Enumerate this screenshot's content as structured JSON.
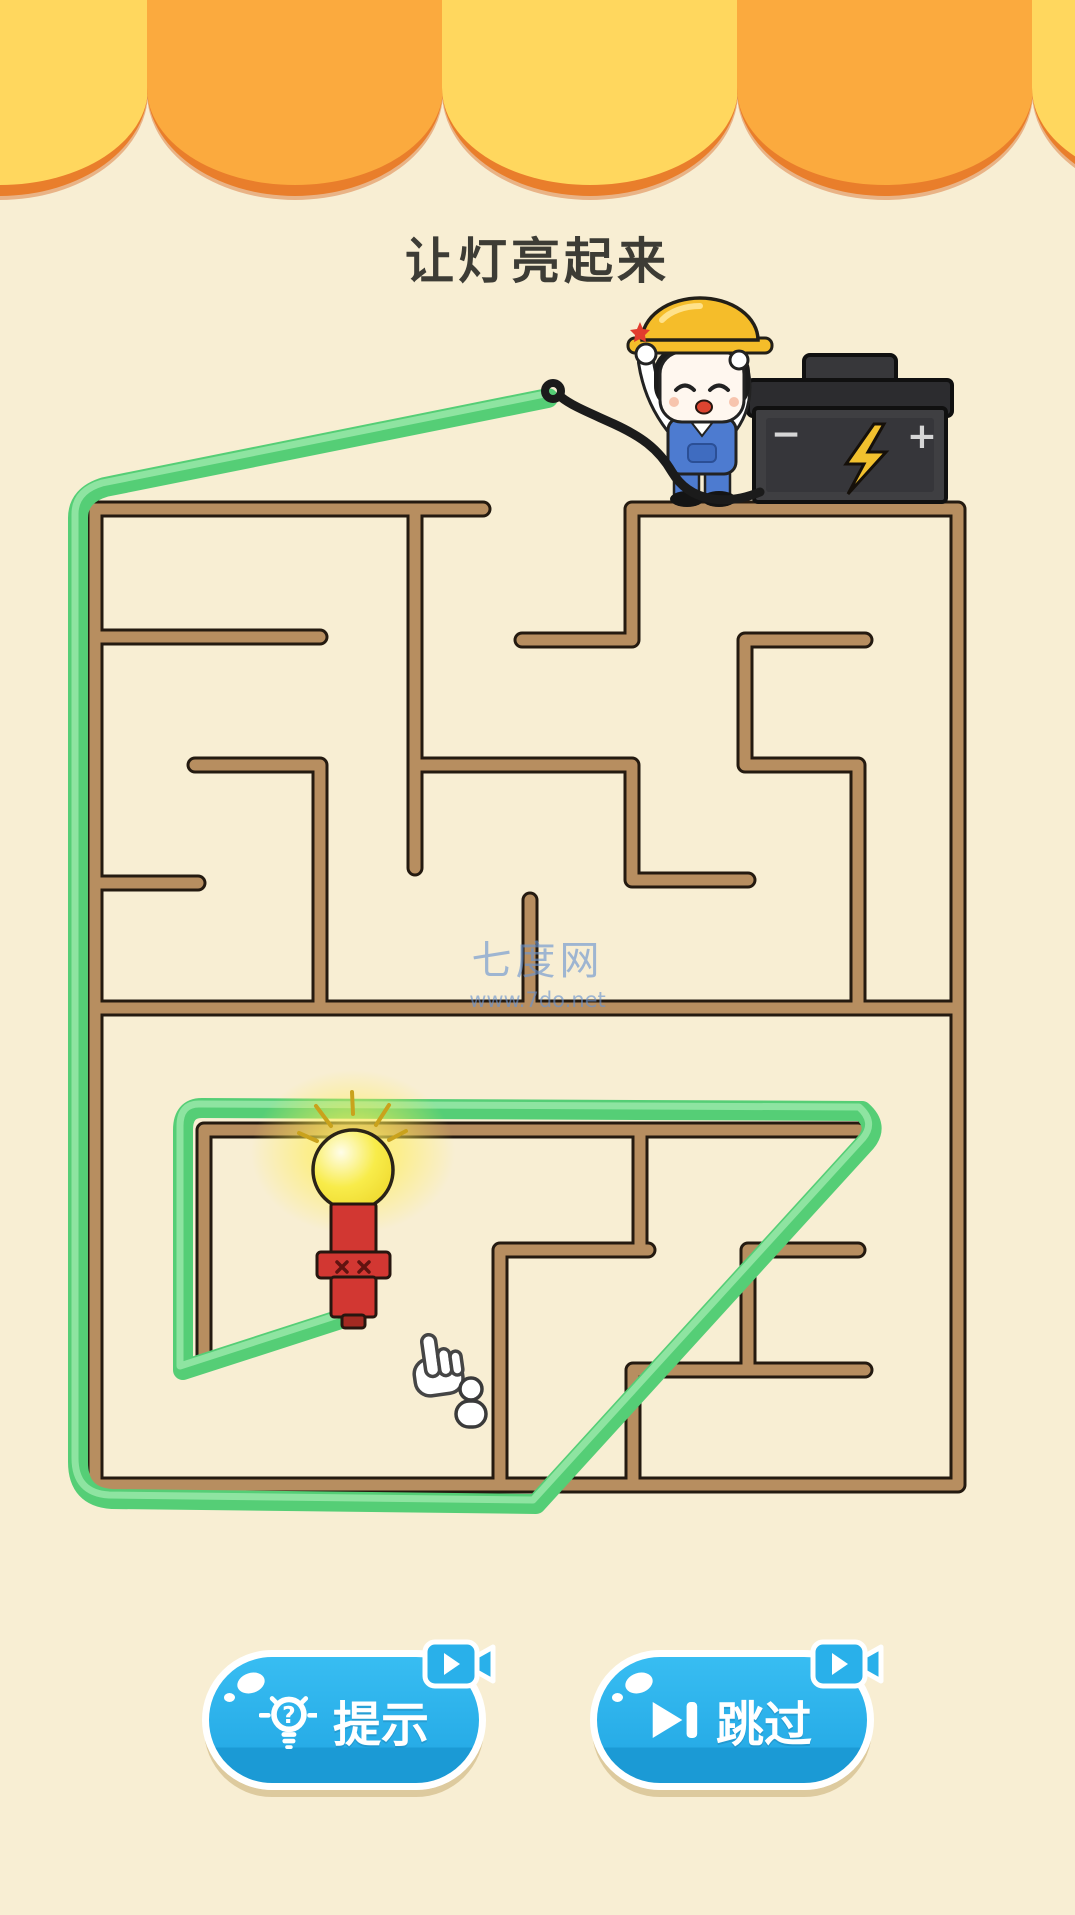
{
  "header": {
    "title": "让灯亮起来"
  },
  "watermark": {
    "site_name": "七度网",
    "site_url": "www.7do.net"
  },
  "battery": {
    "minus_label": "−",
    "plus_label": "+"
  },
  "buttons": {
    "hint": {
      "label": "提示",
      "question_mark": "?"
    },
    "skip": {
      "label": "跳过"
    }
  },
  "colors": {
    "background": "#f8eed3",
    "awning_yellow": "#ffd75e",
    "awning_orange": "#fbaa3e",
    "awning_rim": "#e97e2b",
    "title_text": "#3d3c35",
    "wall_fill": "#b78e60",
    "wall_outline": "#241a10",
    "path_green": "#55ce76",
    "path_green_light": "#95e7a6",
    "button_blue": "#29b5ef",
    "button_blue_dark": "#1593cc",
    "bulb_yellow": "#f8ec4a",
    "bulb_base_red": "#d23732",
    "battery_body": "#3f3f42",
    "bolt_yellow": "#f2c12e",
    "watermark_blue": "#6893d1"
  },
  "maze": {
    "walls": [
      [
        [
          483,
          509
        ],
        [
          95,
          509
        ],
        [
          95,
          1485
        ],
        [
          958,
          1485
        ],
        [
          958,
          509
        ],
        [
          632,
          509
        ],
        [
          632,
          640
        ],
        [
          522,
          640
        ]
      ],
      [
        [
          415,
          509
        ],
        [
          415,
          868
        ]
      ],
      [
        [
          415,
          765
        ],
        [
          632,
          765
        ],
        [
          632,
          880
        ],
        [
          748,
          880
        ]
      ],
      [
        [
          95,
          637
        ],
        [
          320,
          637
        ]
      ],
      [
        [
          195,
          765
        ],
        [
          320,
          765
        ],
        [
          320,
          1008
        ]
      ],
      [
        [
          95,
          883
        ],
        [
          198,
          883
        ]
      ],
      [
        [
          530,
          900
        ],
        [
          530,
          1008
        ]
      ],
      [
        [
          865,
          640
        ],
        [
          745,
          640
        ],
        [
          745,
          765
        ],
        [
          858,
          765
        ],
        [
          858,
          1008
        ]
      ],
      [
        [
          95,
          1008
        ],
        [
          958,
          1008
        ]
      ],
      [
        [
          204,
          1360
        ],
        [
          204,
          1130
        ],
        [
          858,
          1130
        ]
      ],
      [
        [
          640,
          1130
        ],
        [
          640,
          1250
        ]
      ],
      [
        [
          648,
          1250
        ],
        [
          500,
          1250
        ],
        [
          500,
          1485
        ]
      ],
      [
        [
          858,
          1250
        ],
        [
          748,
          1250
        ],
        [
          748,
          1370
        ]
      ],
      [
        [
          865,
          1370
        ],
        [
          633,
          1370
        ],
        [
          633,
          1485
        ]
      ]
    ]
  },
  "drawn_path": {
    "d": "M548,398 L105,487 Q78,495 78,518 L78,1462 Q78,1497 112,1499 L536,1504 L866,1142 Q879,1126 862,1111 L202,1108 Q183,1108 183,1130 L183,1370 L347,1317"
  }
}
